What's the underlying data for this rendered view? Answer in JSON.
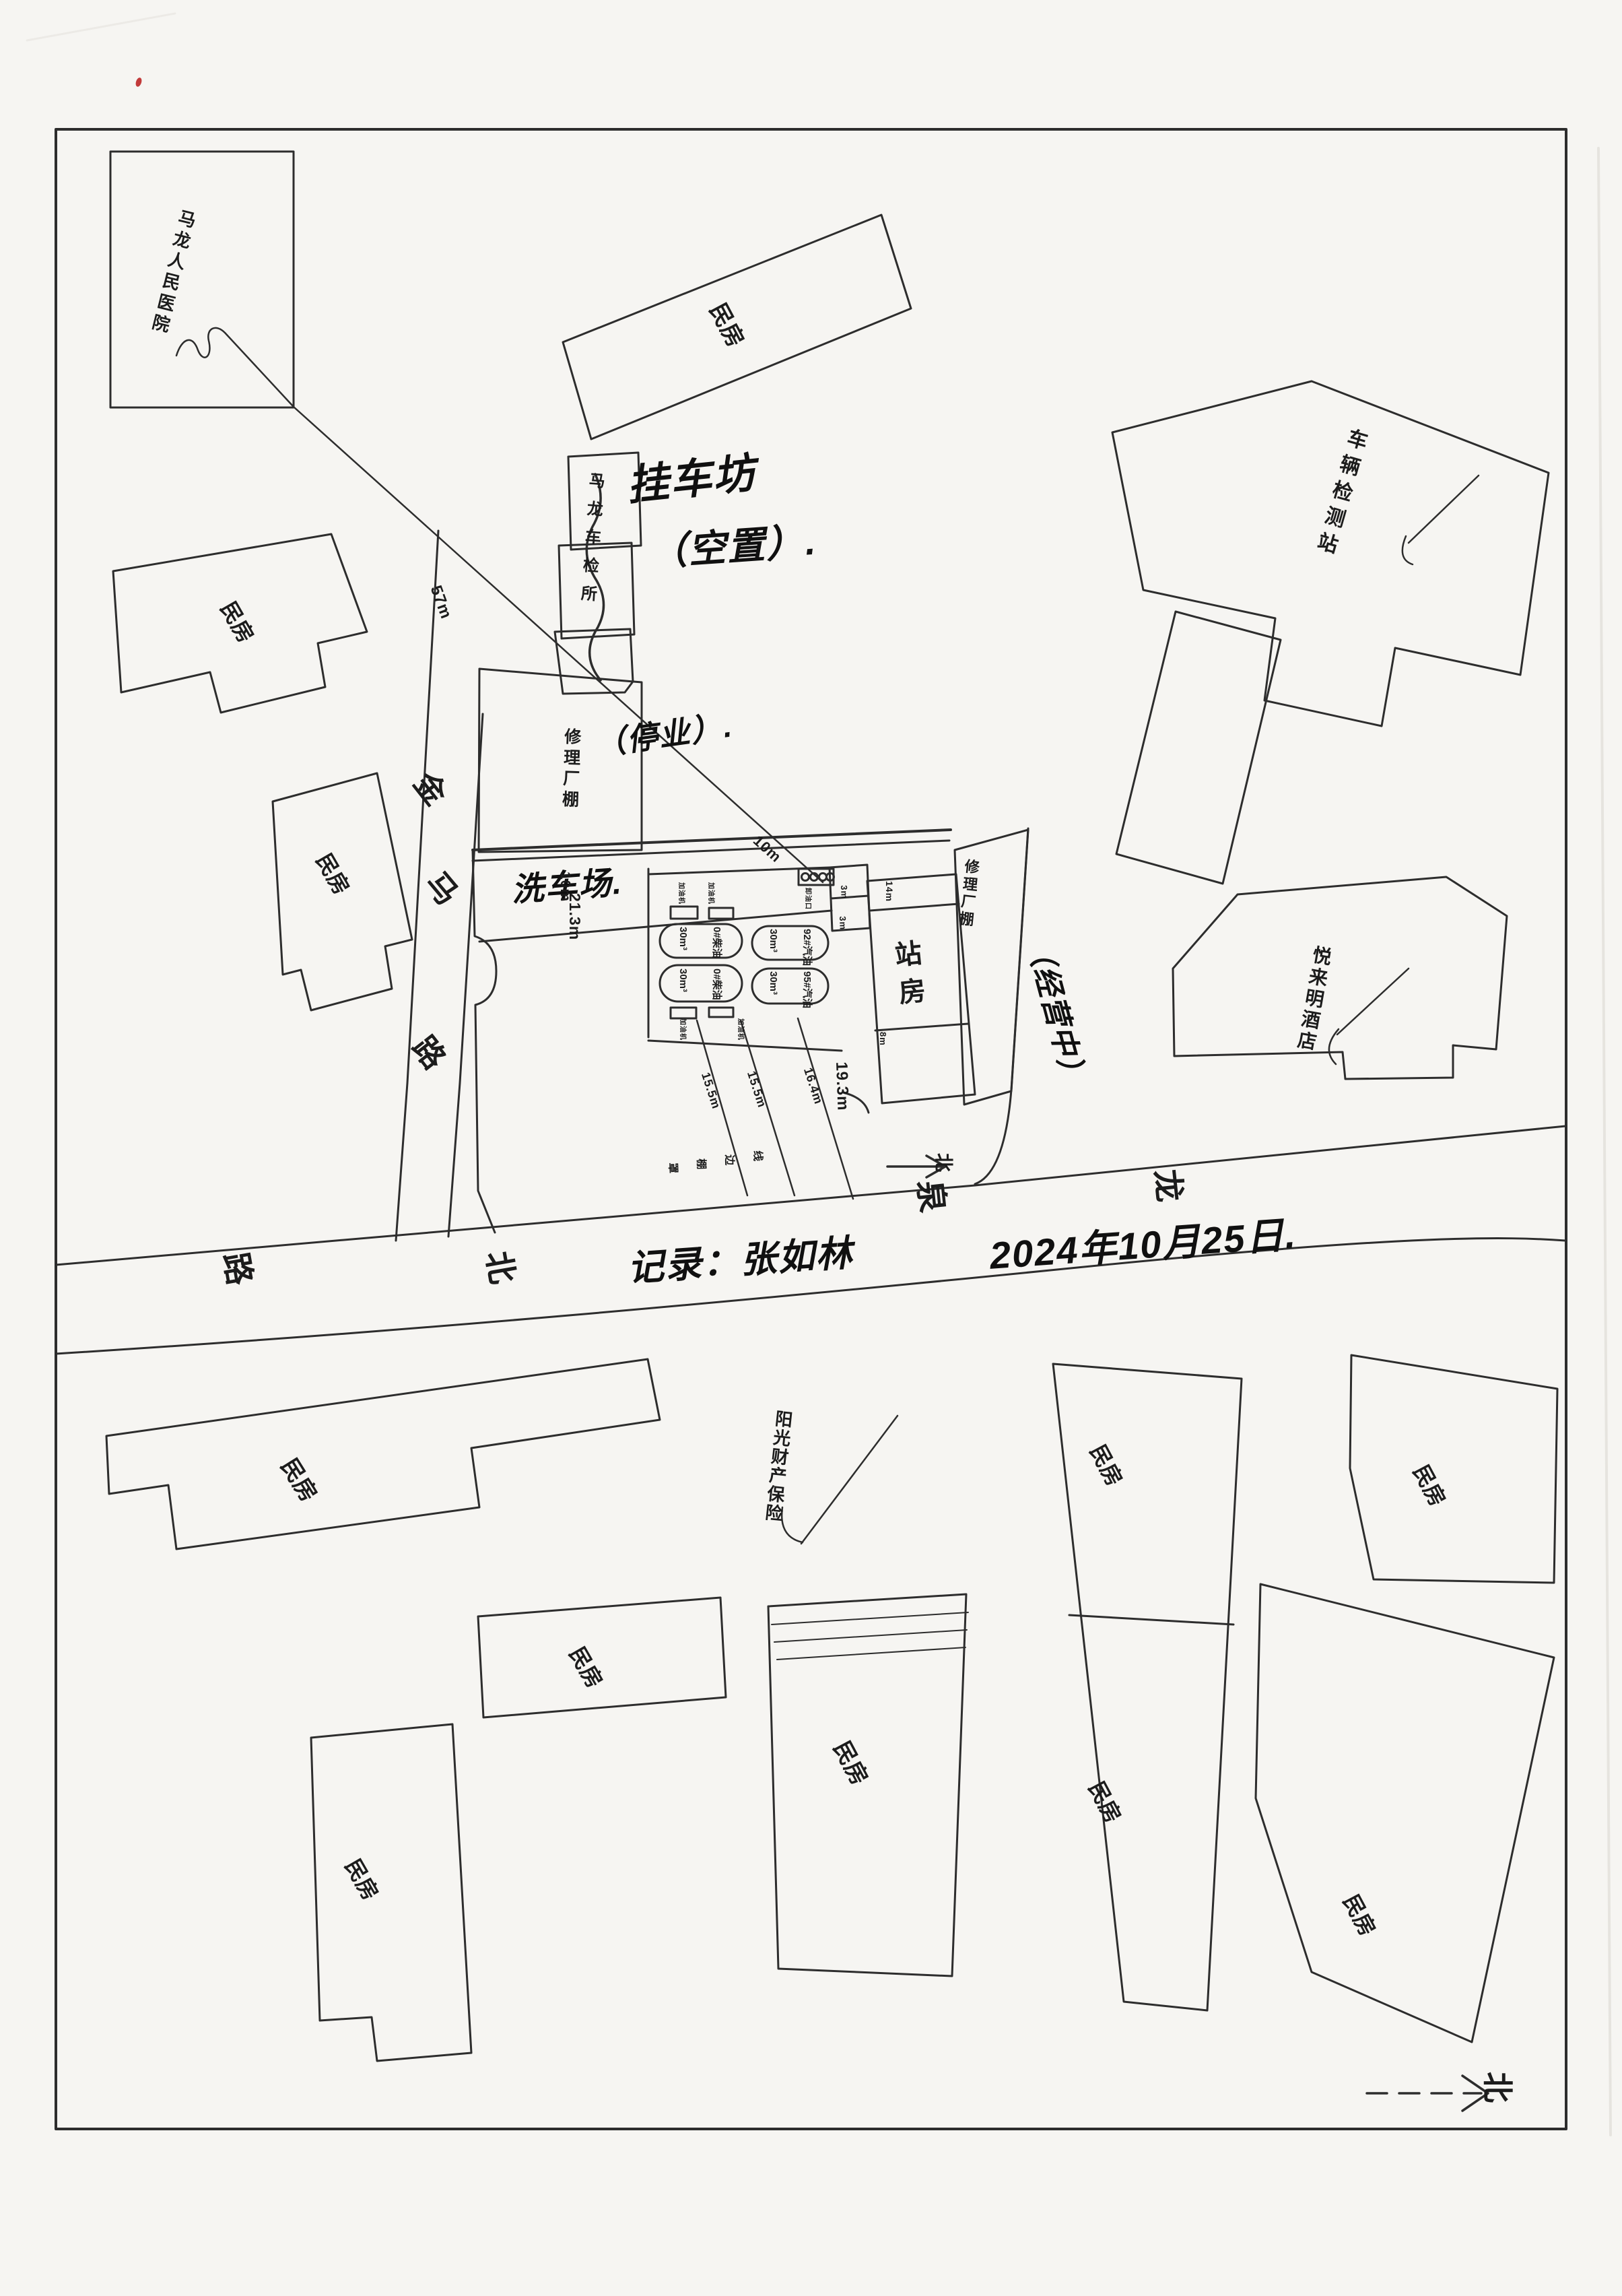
{
  "labels": {
    "hospital": "马龙人民医院",
    "vehicle_station": "车辆检测站",
    "checkpoint": "马龙车检所",
    "hotel": "悦来明酒店",
    "insurance": "阳光财产保险",
    "repair_shed": "修理厂棚",
    "station_house": "站房",
    "minfang": "民房"
  },
  "annotations": {
    "trailer_line1": "挂车坊",
    "trailer_line2": "（空置）.",
    "repair_closed": "（停业）.",
    "repair_open": "（经营中）",
    "car_wash": "洗车场.",
    "record": "记录：张如林",
    "date": "2024年10月25日.",
    "dispenser": "加油机",
    "unload": "卸油口",
    "canopy": [
      "罩",
      "棚",
      "边",
      "线"
    ]
  },
  "roads": {
    "jinma": {
      "chars": [
        "金",
        "马",
        "路"
      ]
    },
    "longquan": {
      "chars": [
        "龙",
        "泉",
        "北",
        "路"
      ]
    }
  },
  "north": {
    "label": "北",
    "label_mid": "北"
  },
  "station": {
    "tanks": [
      {
        "cap": "30m³",
        "prod": "0#柴油"
      },
      {
        "cap": "30m³",
        "prod": "92#汽油"
      },
      {
        "cap": "30m³",
        "prod": "0#柴油"
      },
      {
        "cap": "30m³",
        "prod": "95#汽油"
      }
    ]
  },
  "dims": {
    "d57": "57m",
    "d21": "21.3m",
    "d19": "19.3m",
    "d10a": "10m",
    "d10b": "10m",
    "d14": "14m",
    "d8": "8m",
    "d3a": "3m",
    "d3b": "3m",
    "d15a": "15.5m",
    "d15b": "15.5m",
    "d16": "16.4m"
  }
}
